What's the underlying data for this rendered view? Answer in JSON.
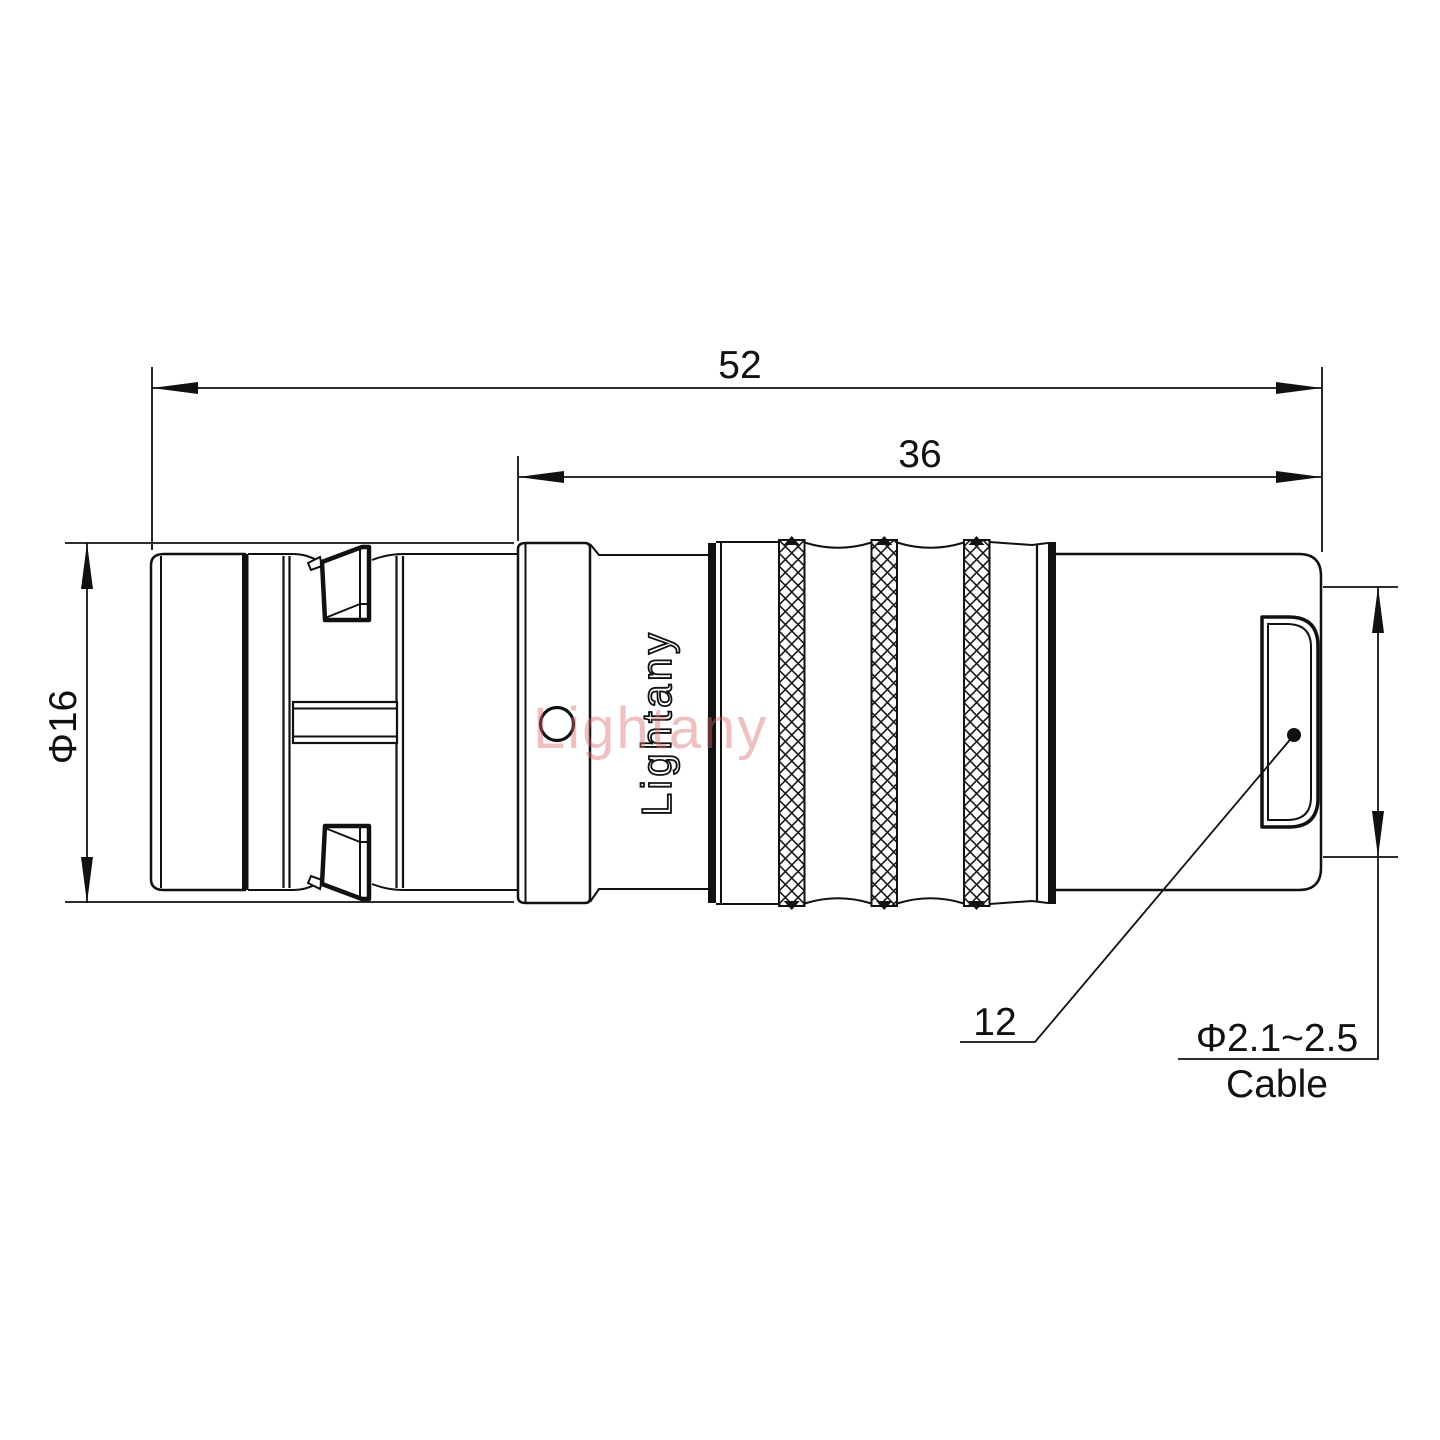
{
  "drawing": {
    "title_hint": "connector-side-view-technical-drawing",
    "dimensions": {
      "overall_length": "52",
      "insert_length": "36",
      "shell_diameter": "Φ16",
      "nut_ref": "12",
      "cable_range": "Φ2.1~2.5",
      "cable_word": "Cable"
    },
    "branding": {
      "logo_text": "Lightany",
      "watermark_text": "Lightany"
    },
    "colors": {
      "line": "#111111",
      "watermark_pink": "#d66a6a",
      "background": "#ffffff"
    }
  }
}
